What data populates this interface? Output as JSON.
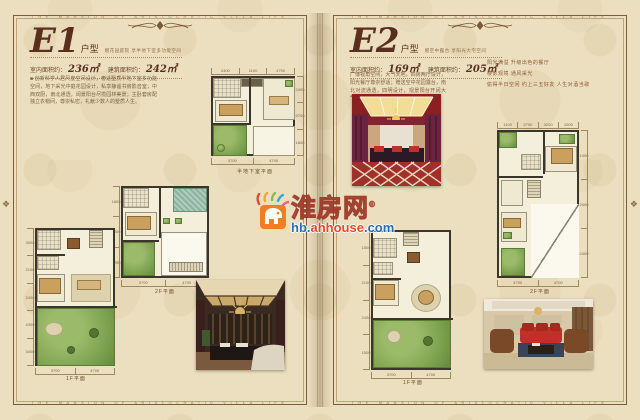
{
  "frame": {
    "band_text": "THE MANSION OF ARISTOCRATIC VILLA LIFE"
  },
  "watermark": {
    "brand": "淮房网",
    "reg": "®",
    "url_a": "hb.",
    "url_b": "ahhouse",
    "url_c": ".com"
  },
  "e1": {
    "code": "E1",
    "type_label": "户型",
    "tagline": "赠花园庭院 享半地下室多功能空间",
    "indoor_label": "室内面积约：",
    "indoor_value": "236㎡",
    "build_label": "建筑面积约：",
    "build_value": "242㎡",
    "description": "■ 创新科学人居尺度空间设计，奢适墅质半地下室多功能空间，地下采光中庭花园设计，私享静谧书房影音室；中西双厨，南北通透，阔景阳台尽揽园林美景；主卧套房配独立衣帽间，尊崇私密，礼献少数人的墅质人生。",
    "basement": {
      "caption": "半地下室平面",
      "d1": "2400",
      "d2": "1100",
      "d3": "4700",
      "r1": "2400",
      "r2": "5700",
      "r3": "1800",
      "b1": "3700",
      "b2": "4700"
    },
    "f2": {
      "caption": "2F平面",
      "l1": "1800",
      "l2": "2000",
      "l3": "4200",
      "b1": "3700",
      "b2": "4700"
    },
    "f1": {
      "caption": "1F平面",
      "l1": "3500",
      "l2": "2100",
      "l3": "2400",
      "l4": "4300",
      "l5": "3400",
      "b1": "3700",
      "b2": "4700"
    }
  },
  "e2": {
    "code": "E2",
    "type_label": "户型",
    "tagline": "赠空中露台 享阳光大宅空间",
    "indoor_label": "室内面积约：",
    "indoor_value": "169㎡",
    "build_label": "建筑面积约：",
    "build_value": "205㎡",
    "description": "广博视角空间，大气天地，四房两厅设计，阳光餐厅尊崇舒适；赠送空中花园露台，南北对流通透，四明设计，观景阳台开阔大气，品质生活触手可及。",
    "line1": "阳光满溢 升级出色的餐厅",
    "line2": "楼影观境 通风采光",
    "line3": "偷得半日空闲 约上三五好友 人生对酒当歌",
    "f2": {
      "caption": "2F平面",
      "d1": "1100",
      "d2": "2700",
      "d3": "3200",
      "d4": "1000",
      "r1": "1000",
      "r2": "2400",
      "r3": "2400",
      "b1": "4700",
      "b2": "4700"
    },
    "f1": {
      "caption": "1F平面",
      "l1": "1500",
      "l2": "2100",
      "l3": "2400",
      "l4": "1500",
      "b1": "3700",
      "b2": "4700"
    }
  }
}
